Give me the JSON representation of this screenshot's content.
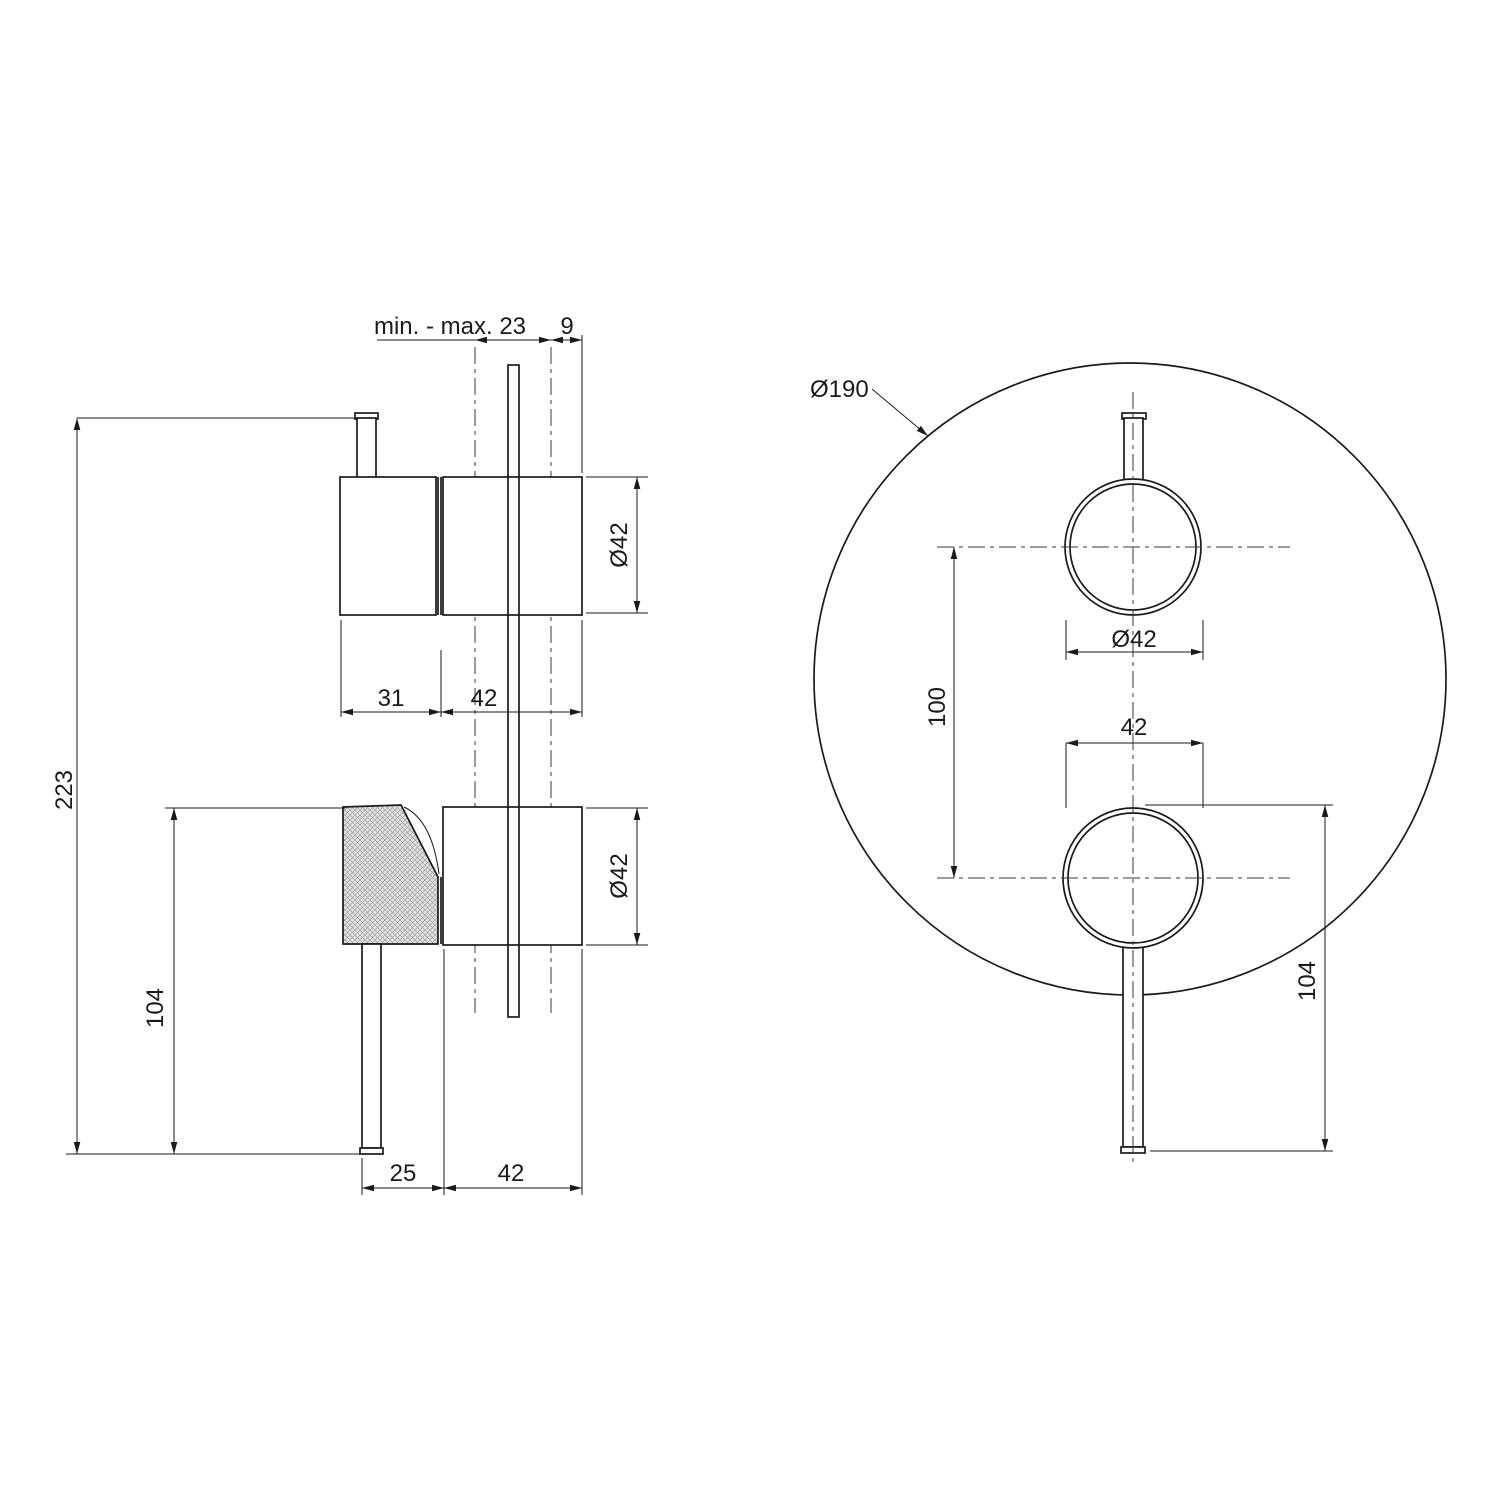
{
  "drawing": {
    "description": "Technical dimension drawing of concealed shower mixer: side view (left) and front view with round plate (right)",
    "colors": {
      "line": "#1a1a1a",
      "background": "#ffffff",
      "knurl_fill": "#e2e2e2",
      "knurl_hatch": "#a0a0a0"
    },
    "side_view": {
      "dims": {
        "wall_range": "min. - max. 23",
        "plate_offset": "9",
        "knob_dia_top": "Ø42",
        "knob_len": "31",
        "body_len_top": "42",
        "total_height": "223",
        "handle_height": "104",
        "knob_dia_bottom": "Ø42",
        "lever_offset": "25",
        "body_len_bottom": "42"
      }
    },
    "front_view": {
      "dims": {
        "plate_dia": "Ø190",
        "knob_dia": "Ø42",
        "knob_spacing": "100",
        "knob_width": "42",
        "lever_drop": "104"
      }
    }
  }
}
